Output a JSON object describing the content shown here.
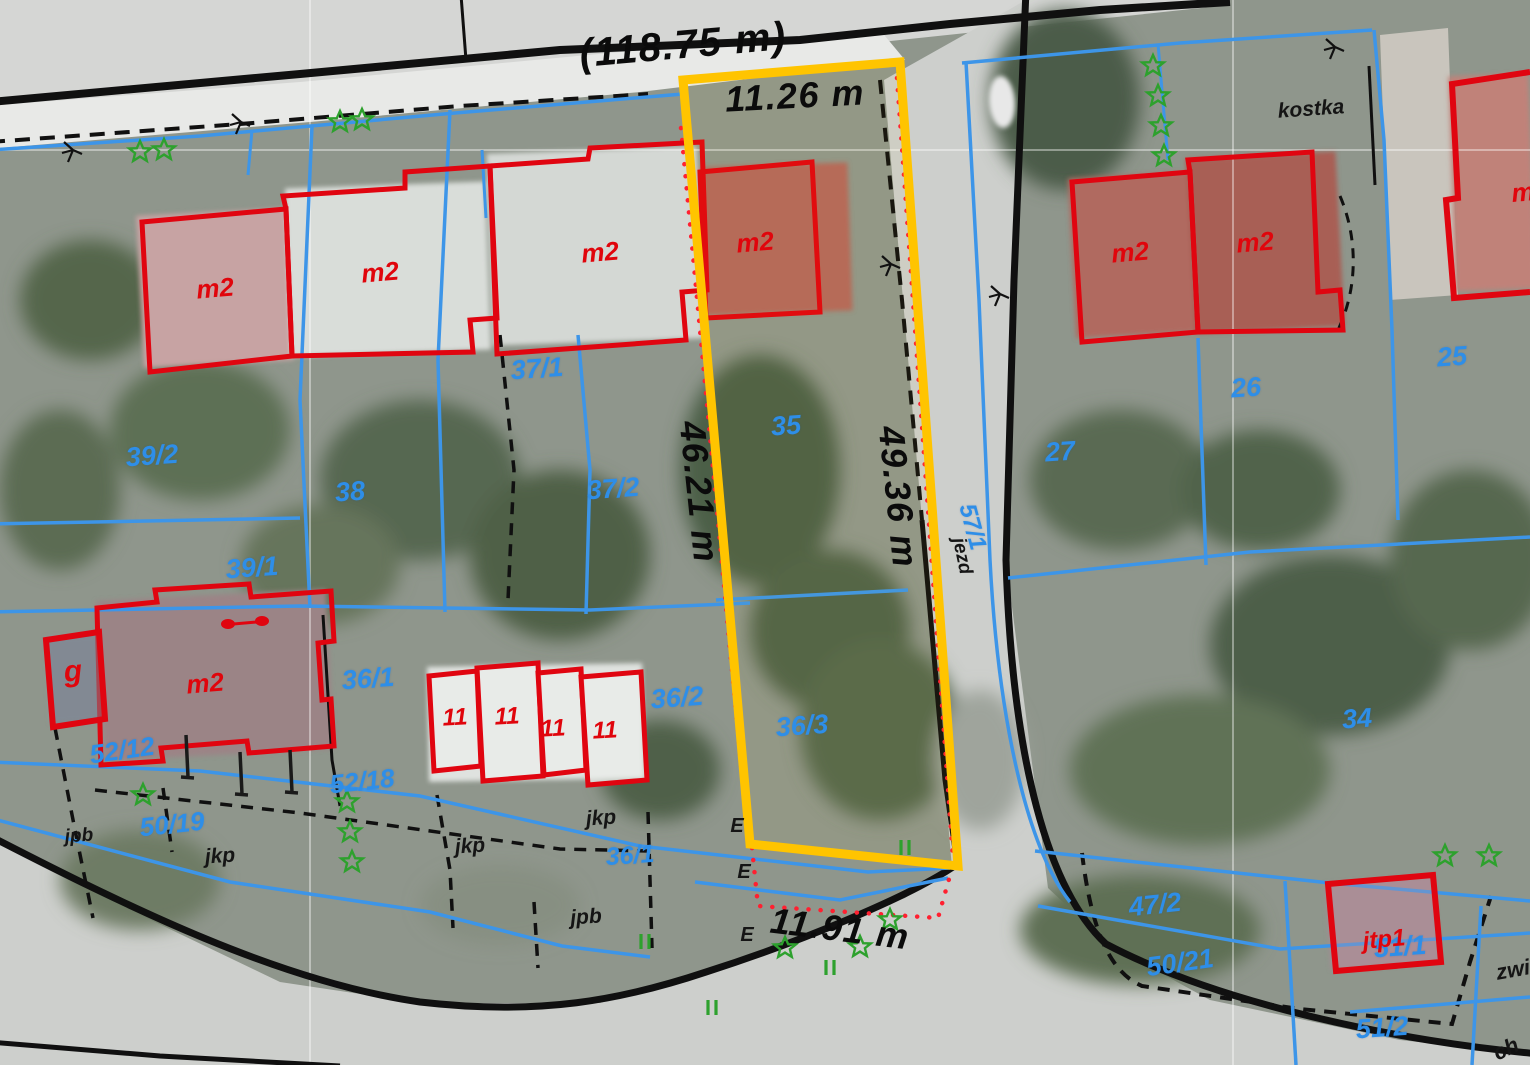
{
  "map": {
    "title": "cadastral parcel map on aerial photo",
    "highlighted_parcel": {
      "outline_color": "#ffc400",
      "street_frontage_total": "(118.75 m)",
      "front_width": "11.26 m",
      "left_side_length": "46.21 m",
      "right_side_length": "49.36 m",
      "rear_width": "11.91 m"
    },
    "colors": {
      "highlight": "#ffc400",
      "parcel_line": "#3d95e8",
      "building_outline": "#e00510",
      "road_line": "#101010",
      "setback_dotted": "#ff2030",
      "tree": "#2da12d",
      "parcel_text": "#2e8ee8",
      "dimension_text": "#0b0b0b"
    },
    "labels": [
      {
        "name": "frontage-total",
        "layer": "dimension",
        "text": "(118.75 m)",
        "x": 683,
        "y": 45,
        "size": 40,
        "rot": -5
      },
      {
        "name": "dim-front",
        "layer": "dimension",
        "text": "11.26 m",
        "x": 795,
        "y": 96,
        "size": 36,
        "rot": -3
      },
      {
        "name": "dim-left-side",
        "layer": "dimension",
        "text": "46.21 m",
        "x": 699,
        "y": 492,
        "size": 36,
        "rot": 84
      },
      {
        "name": "dim-right-side",
        "layer": "dimension",
        "text": "49.36 m",
        "x": 898,
        "y": 497,
        "size": 36,
        "rot": 84
      },
      {
        "name": "dim-rear",
        "layer": "dimension",
        "text": "11.91 m",
        "x": 840,
        "y": 929,
        "size": 36,
        "rot": 7
      },
      {
        "name": "parcel-39-2",
        "layer": "parcel",
        "text": "39/2",
        "x": 152,
        "y": 456,
        "size": 27,
        "rot": -4
      },
      {
        "name": "parcel-38",
        "layer": "parcel",
        "text": "38",
        "x": 350,
        "y": 492,
        "size": 27,
        "rot": -4
      },
      {
        "name": "parcel-39-1",
        "layer": "parcel",
        "text": "39/1",
        "x": 252,
        "y": 568,
        "size": 27,
        "rot": -4
      },
      {
        "name": "parcel-37-1",
        "layer": "parcel",
        "text": "37/1",
        "x": 537,
        "y": 369,
        "size": 27,
        "rot": -4
      },
      {
        "name": "parcel-37-2",
        "layer": "parcel",
        "text": "37/2",
        "x": 613,
        "y": 489,
        "size": 27,
        "rot": -4
      },
      {
        "name": "parcel-35",
        "layer": "parcel",
        "text": "35",
        "x": 786,
        "y": 426,
        "size": 27,
        "rot": -4
      },
      {
        "name": "parcel-36-1",
        "layer": "parcel",
        "text": "36/1",
        "x": 368,
        "y": 679,
        "size": 27,
        "rot": -4
      },
      {
        "name": "parcel-36-2",
        "layer": "parcel",
        "text": "36/2",
        "x": 677,
        "y": 698,
        "size": 27,
        "rot": -4
      },
      {
        "name": "parcel-36-3",
        "layer": "parcel",
        "text": "36/3",
        "x": 802,
        "y": 726,
        "size": 27,
        "rot": -4
      },
      {
        "name": "parcel-36-1-b",
        "layer": "parcel",
        "text": "36/1",
        "x": 630,
        "y": 856,
        "size": 25,
        "rot": -4
      },
      {
        "name": "parcel-52-12",
        "layer": "parcel",
        "text": "52/12",
        "x": 122,
        "y": 750,
        "size": 26,
        "rot": -8
      },
      {
        "name": "parcel-50-19",
        "layer": "parcel",
        "text": "50/19",
        "x": 172,
        "y": 824,
        "size": 26,
        "rot": -6
      },
      {
        "name": "parcel-52-18",
        "layer": "parcel",
        "text": "52/18",
        "x": 362,
        "y": 781,
        "size": 26,
        "rot": -6
      },
      {
        "name": "parcel-27",
        "layer": "parcel",
        "text": "27",
        "x": 1060,
        "y": 452,
        "size": 27,
        "rot": -4
      },
      {
        "name": "parcel-26",
        "layer": "parcel",
        "text": "26",
        "x": 1246,
        "y": 388,
        "size": 27,
        "rot": -4
      },
      {
        "name": "parcel-25",
        "layer": "parcel",
        "text": "25",
        "x": 1452,
        "y": 357,
        "size": 27,
        "rot": -4
      },
      {
        "name": "parcel-34",
        "layer": "parcel",
        "text": "34",
        "x": 1357,
        "y": 719,
        "size": 27,
        "rot": -4
      },
      {
        "name": "parcel-47-2",
        "layer": "parcel",
        "text": "47/2",
        "x": 1155,
        "y": 905,
        "size": 27,
        "rot": -6
      },
      {
        "name": "parcel-50-21",
        "layer": "parcel",
        "text": "50/21",
        "x": 1180,
        "y": 963,
        "size": 27,
        "rot": -8
      },
      {
        "name": "parcel-51-1",
        "layer": "parcel",
        "text": "51/1",
        "x": 1400,
        "y": 947,
        "size": 27,
        "rot": -4
      },
      {
        "name": "parcel-51-2",
        "layer": "parcel",
        "text": "51/2",
        "x": 1382,
        "y": 1028,
        "size": 27,
        "rot": -4
      },
      {
        "name": "parcel-57-1",
        "layer": "parcel",
        "text": "57/1",
        "x": 972,
        "y": 527,
        "size": 24,
        "rot": 75
      },
      {
        "name": "surface-kostka",
        "layer": "surface",
        "text": "kostka",
        "x": 1311,
        "y": 109,
        "size": 21,
        "rot": -4
      },
      {
        "name": "surface-jkp-1",
        "layer": "surface",
        "text": "jkp",
        "x": 470,
        "y": 846,
        "size": 21,
        "rot": -4
      },
      {
        "name": "surface-jkp-2",
        "layer": "surface",
        "text": "jkp",
        "x": 601,
        "y": 818,
        "size": 21,
        "rot": -4
      },
      {
        "name": "surface-jkp-3",
        "layer": "surface",
        "text": "jkp",
        "x": 220,
        "y": 856,
        "size": 21,
        "rot": -4
      },
      {
        "name": "surface-jpb-1",
        "layer": "surface",
        "text": "jpb",
        "x": 586,
        "y": 917,
        "size": 21,
        "rot": -4
      },
      {
        "name": "surface-jpb-2",
        "layer": "surface",
        "text": "jpb",
        "x": 79,
        "y": 836,
        "size": 19,
        "rot": -4
      },
      {
        "name": "surface-jezd",
        "layer": "surface",
        "text": "jezd",
        "x": 962,
        "y": 556,
        "size": 19,
        "rot": 78
      },
      {
        "name": "surface-zwi",
        "layer": "surface",
        "text": "zwi",
        "x": 1513,
        "y": 970,
        "size": 22,
        "rot": -10
      },
      {
        "name": "surface-ch",
        "layer": "surface",
        "text": "ch",
        "x": 1506,
        "y": 1049,
        "size": 22,
        "rot": -25
      },
      {
        "name": "mark-e-1",
        "layer": "surface",
        "text": "E",
        "x": 737,
        "y": 826,
        "size": 20,
        "rot": 0
      },
      {
        "name": "mark-e-2",
        "layer": "surface",
        "text": "E",
        "x": 744,
        "y": 872,
        "size": 20,
        "rot": 0
      },
      {
        "name": "mark-e-3",
        "layer": "surface",
        "text": "E",
        "x": 747,
        "y": 935,
        "size": 20,
        "rot": 0
      },
      {
        "name": "building-m2-1",
        "layer": "building",
        "text": "m2",
        "x": 215,
        "y": 288,
        "size": 26,
        "rot": -5
      },
      {
        "name": "building-m2-2",
        "layer": "building",
        "text": "m2",
        "x": 380,
        "y": 272,
        "size": 26,
        "rot": -5
      },
      {
        "name": "building-m2-3",
        "layer": "building",
        "text": "m2",
        "x": 600,
        "y": 252,
        "size": 26,
        "rot": -5
      },
      {
        "name": "building-m2-4",
        "layer": "building",
        "text": "m2",
        "x": 755,
        "y": 242,
        "size": 26,
        "rot": -5
      },
      {
        "name": "building-m2-5",
        "layer": "building",
        "text": "m2",
        "x": 1130,
        "y": 252,
        "size": 26,
        "rot": -5
      },
      {
        "name": "building-m2-6",
        "layer": "building",
        "text": "m2",
        "x": 1255,
        "y": 242,
        "size": 26,
        "rot": -5
      },
      {
        "name": "building-m2-7",
        "layer": "building",
        "text": "m2",
        "x": 205,
        "y": 683,
        "size": 26,
        "rot": -5
      },
      {
        "name": "building-m-partial",
        "layer": "building",
        "text": "m",
        "x": 1523,
        "y": 192,
        "size": 26,
        "rot": -5
      },
      {
        "name": "building-11-1",
        "layer": "building",
        "text": "11",
        "x": 455,
        "y": 718,
        "size": 24,
        "rot": -3
      },
      {
        "name": "building-11-2",
        "layer": "building",
        "text": "11",
        "x": 507,
        "y": 717,
        "size": 24,
        "rot": -3
      },
      {
        "name": "building-11-3",
        "layer": "building",
        "text": "11",
        "x": 553,
        "y": 729,
        "size": 24,
        "rot": -3
      },
      {
        "name": "building-11-4",
        "layer": "building",
        "text": "11",
        "x": 605,
        "y": 731,
        "size": 24,
        "rot": -3
      },
      {
        "name": "building-g",
        "layer": "building",
        "text": "g",
        "x": 73,
        "y": 672,
        "size": 30,
        "rot": -5
      },
      {
        "name": "building-jtp1",
        "layer": "building",
        "text": "jtp1",
        "x": 1384,
        "y": 940,
        "size": 24,
        "rot": -5
      }
    ],
    "trees": [
      [
        140,
        152
      ],
      [
        164,
        150
      ],
      [
        340,
        122
      ],
      [
        362,
        120
      ],
      [
        1153,
        66
      ],
      [
        1158,
        96
      ],
      [
        1161,
        126
      ],
      [
        1164,
        156
      ],
      [
        143,
        795
      ],
      [
        347,
        802
      ],
      [
        350,
        832
      ],
      [
        352,
        862
      ],
      [
        785,
        948
      ],
      [
        860,
        947
      ],
      [
        890,
        920
      ],
      [
        1445,
        856
      ],
      [
        1489,
        856
      ]
    ],
    "grass_marks": [
      [
        645,
        942
      ],
      [
        830,
        968
      ],
      [
        712,
        1008
      ],
      [
        905,
        848
      ]
    ],
    "branch_marks": [
      [
        888,
        262
      ],
      [
        997,
        292
      ],
      [
        238,
        120
      ],
      [
        1332,
        45
      ],
      [
        70,
        148
      ]
    ],
    "fence_posts": [
      [
        186,
        735
      ],
      [
        240,
        752
      ],
      [
        290,
        750
      ]
    ]
  }
}
